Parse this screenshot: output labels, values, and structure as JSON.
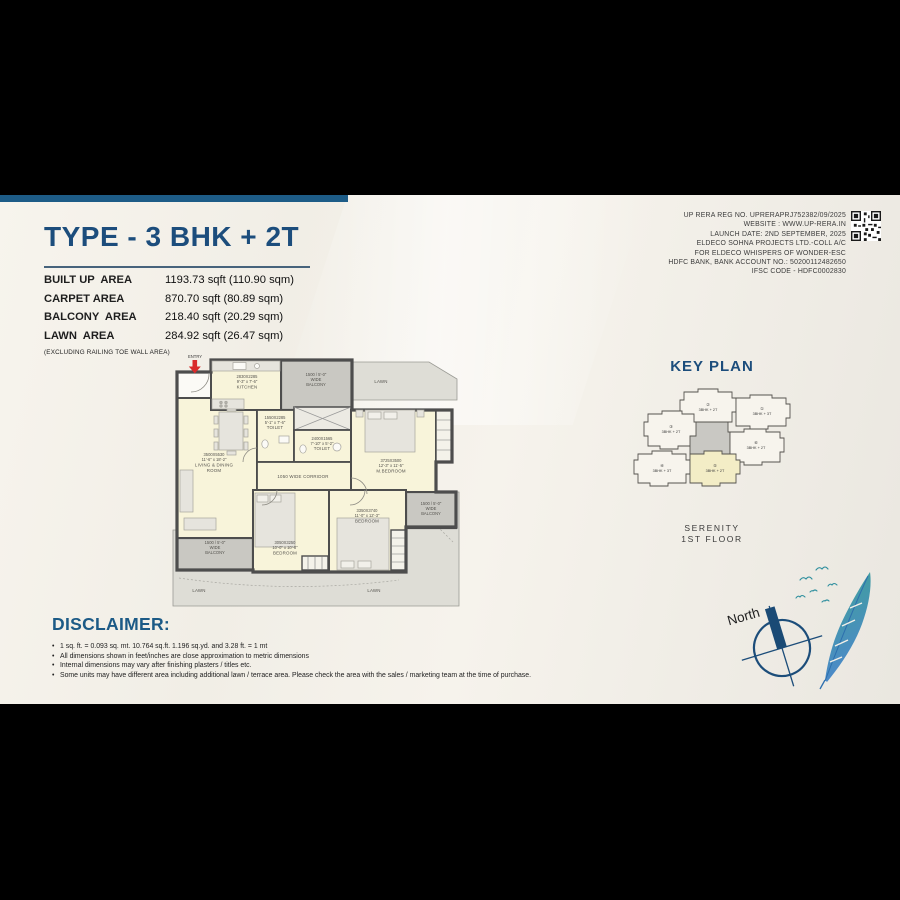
{
  "header": {
    "title": "TYPE - 3 BHK + 2T",
    "areas": [
      {
        "label": "BUILT UP  AREA",
        "value": "1193.73 sqft (110.90 sqm)"
      },
      {
        "label": "CARPET AREA",
        "value": "870.70 sqft (80.89 sqm)"
      },
      {
        "label": "BALCONY  AREA",
        "value": "218.40 sqft (20.29 sqm)"
      },
      {
        "label": "LAWN  AREA",
        "value": "284.92 sqft (26.47 sqm)"
      }
    ],
    "note": "(EXCLUDING RAILING TOE WALL AREA)"
  },
  "rera": {
    "line1": "UP RERA REG NO. UPRERAPRJ752382/09/2025",
    "line2": "WEBSITE : WWW.UP-RERA.IN",
    "line3": "LAUNCH DATE: 2ND SEPTEMBER, 2025",
    "line4": "ELDECO SOHNA PROJECTS LTD.-COLL A/C",
    "line5": "FOR ELDECO WHISPERS OF WONDER-ESC",
    "line6": "HDFC BANK, BANK ACCOUNT NO.: 50200112482650",
    "line7": "IFSC CODE - HDFC0002830"
  },
  "floorplan": {
    "entry": "ENTRY",
    "kitchen": {
      "mm": "2830X2285",
      "ft": "9'-3\" x 7'-6\"",
      "name": "KITCHEN"
    },
    "toilet1": {
      "mm": "1550X2285",
      "ft": "5'-1\" x 7'-6\"",
      "name": "TOILET"
    },
    "toilet2": {
      "mm": "2400X1565",
      "ft": "7'-10\" x 5'-2\"",
      "name": "TOILET"
    },
    "living": {
      "mm": "3500X5530",
      "ft": "11'-6\" x 18'-2\"",
      "name1": "LIVING & DINING",
      "name2": "ROOM"
    },
    "corridor": "1050 WIDE CORRIDOR",
    "mbedroom": {
      "mm": "3725X3500",
      "ft": "12'-3\" x 11'-5\"",
      "name": "M.BEDROOM"
    },
    "bedroom2": {
      "mm": "3350X3740",
      "ft": "11'-0\" x 12'-3\"",
      "name": "BEDROOM"
    },
    "bedroom3": {
      "mm": "3050X3250",
      "ft": "10'-0\" x 10'-8\"",
      "name": "BEDROOM"
    },
    "balcony": {
      "l1": "1500 / 5'-0\"",
      "l2": "WIDE",
      "l3": "BALCONY"
    },
    "lawn": "LAWN"
  },
  "keyplan": {
    "title": "KEY PLAN",
    "units": [
      {
        "num": "①",
        "type": "3BHK + 3T"
      },
      {
        "num": "②",
        "type": "3BHK + 2T"
      },
      {
        "num": "③",
        "type": "3BHK + 2T"
      },
      {
        "num": "④",
        "type": "3BHK + 3T"
      },
      {
        "num": "⑤",
        "type": "3BHK + 2T"
      },
      {
        "num": "⑥",
        "type": "3BHK + 2T"
      }
    ],
    "tower": "SERENITY",
    "floor": "1ST FLOOR"
  },
  "compass": {
    "label": "North"
  },
  "disclaimer": {
    "title": "DISCLAIMER:",
    "bullets": [
      "1 sq. ft. = 0.093 sq. mt. 10.764 sq.ft. 1.196 sq.yd. and 3.28 ft. = 1 mt",
      "All dimensions shown in feet/inches are close approximation to metric dimensions",
      "Internal dimensions may vary after finishing plasters / titles etc.",
      "Some units may have different area including  additional lawn / terrace area. Please check the area with the sales / marketing team at the time of purchase."
    ]
  }
}
